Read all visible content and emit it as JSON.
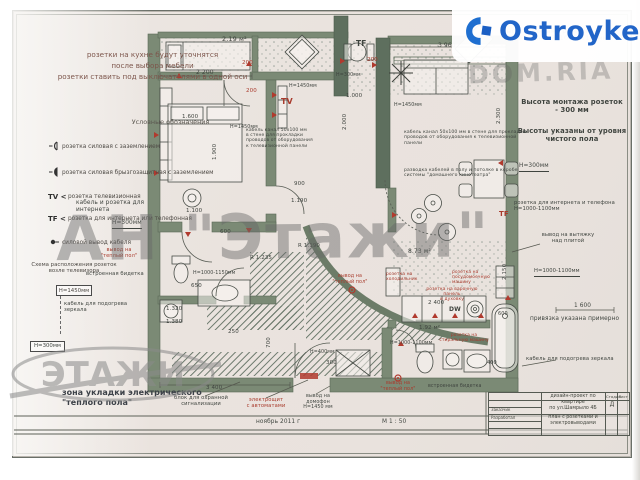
{
  "watermarks": {
    "brand": "Ostroyke",
    "domria": "DOM.RIA",
    "agency": "АН \"Этажи\"",
    "agency_logo": "ЭТАЖИ"
  },
  "notes_top_left": {
    "text": "розетки на кухне будут уточнятся\nпосле выбора мебели\nрозетки ставить под выключателями в одной оси"
  },
  "legend": {
    "title": "Условные обозначения",
    "items": [
      {
        "icon": "socket-grounded-icon",
        "label": "розетка силовая с заземлением"
      },
      {
        "icon": "socket-splashproof-icon",
        "label": "розетка силовая брызгозащитная с заземлением"
      },
      {
        "key": "TV <",
        "label": "розетка телевизионная"
      },
      {
        "key": "TF <",
        "label": "розетка для интернета или телефонная"
      },
      {
        "icon": "cable-outlet-icon",
        "label": "силовой вывод кабеля"
      }
    ]
  },
  "tv_scheme": {
    "title": "Схема расположения розеток\nвозле телевизора",
    "box_top": "Н=1450мм",
    "box_bottom": "Н=300мм"
  },
  "zone_note": "зона укладки электрического\n\"теплого пола\"",
  "title_block": {
    "project": "дизайн-проект по квартире\nпо ул.Шамрыло 4Б",
    "drawing": "план с розетками и\nэлектровыводами",
    "stage_label": "Стадия",
    "sheet_label": "Лист",
    "stage": "Д",
    "row1": "Заказчик",
    "row2": "Разработал"
  },
  "colors": {
    "red": "#a93b2d",
    "ink": "#3f443f",
    "gray2": "#5c5f66"
  },
  "labels": [
    {
      "t": "2.19 м²",
      "x": 222,
      "y": 36,
      "s": 6.5
    },
    {
      "t": "2 200",
      "x": 196,
      "y": 70,
      "s": 6
    },
    {
      "t": "200",
      "x": 242,
      "y": 60,
      "c": "red",
      "s": 5.5
    },
    {
      "t": "200",
      "x": 246,
      "y": 88,
      "c": "red",
      "s": 5.5
    },
    {
      "t": "1.600",
      "x": 182,
      "y": 114,
      "s": 5.5
    },
    {
      "t": "1.900",
      "x": 212,
      "y": 160,
      "r": -90,
      "s": 5.5
    },
    {
      "t": "H=1450мм",
      "x": 230,
      "y": 125,
      "s": 4.8
    },
    {
      "t": "H=1450мм",
      "x": 289,
      "y": 84,
      "s": 4.8
    },
    {
      "t": "TV",
      "x": 281,
      "y": 97,
      "c": "red",
      "s": 8,
      "b": 1
    },
    {
      "t": "1.100",
      "x": 186,
      "y": 208,
      "s": 5.5
    },
    {
      "t": "600",
      "x": 220,
      "y": 229,
      "s": 5.5
    },
    {
      "t": "H=1000-1150мм",
      "x": 193,
      "y": 271,
      "s": 4.8
    },
    {
      "t": "650",
      "x": 191,
      "y": 283,
      "s": 5.5
    },
    {
      "t": "1.320",
      "x": 166,
      "y": 306,
      "s": 5.5
    },
    {
      "t": "1.380",
      "x": 166,
      "y": 319,
      "s": 5.5
    },
    {
      "t": "R 1.235",
      "x": 250,
      "y": 255,
      "s": 5.5
    },
    {
      "t": "R 1.190",
      "x": 298,
      "y": 243,
      "s": 5.5
    },
    {
      "t": "900",
      "x": 294,
      "y": 181,
      "s": 5.5
    },
    {
      "t": "1.190",
      "x": 291,
      "y": 198,
      "s": 5.5
    },
    {
      "t": "700",
      "x": 266,
      "y": 348,
      "r": -90,
      "s": 5.5
    },
    {
      "t": "250",
      "x": 228,
      "y": 329,
      "s": 5.5
    },
    {
      "t": "3 400",
      "x": 206,
      "y": 385,
      "s": 5.5
    },
    {
      "t": "300",
      "x": 326,
      "y": 360,
      "s": 5.5
    },
    {
      "t": "H=400мм",
      "x": 310,
      "y": 350,
      "s": 4.8
    },
    {
      "t": "TF",
      "x": 356,
      "y": 40,
      "s": 7.5,
      "b": 1
    },
    {
      "t": "H=300мм",
      "x": 336,
      "y": 73,
      "s": 4.8
    },
    {
      "t": "1.000",
      "x": 346,
      "y": 93,
      "s": 5.5
    },
    {
      "t": "2.000",
      "x": 342,
      "y": 130,
      "r": -90,
      "s": 5.5
    },
    {
      "t": "200",
      "x": 367,
      "y": 57,
      "c": "red",
      "s": 5.5
    },
    {
      "t": "3 960",
      "x": 438,
      "y": 43,
      "s": 6
    },
    {
      "t": "2.300",
      "x": 496,
      "y": 124,
      "r": -90,
      "s": 5.5
    },
    {
      "t": "H=1450мм",
      "x": 394,
      "y": 103,
      "s": 4.8
    },
    {
      "t": "кабель канал 50х100 мм\nв стене для прокладки\nпроводов от оборудования\nк телевизионной панели",
      "x": 246,
      "y": 128,
      "w": 92,
      "s": 4.5
    },
    {
      "t": "кабель канал 50х100 мм в стене для прокладки\nпроводов от оборудования к телевизионной панели",
      "x": 404,
      "y": 130,
      "w": 124,
      "s": 4.6
    },
    {
      "t": "разводка кабелей в полу и потолке в коробе\nсистемы \"домашнего кинотеатра\"",
      "x": 404,
      "y": 168,
      "w": 124,
      "s": 4.6
    },
    {
      "t": "8.73 м²",
      "x": 408,
      "y": 249,
      "s": 6
    },
    {
      "t": "2.150",
      "x": 502,
      "y": 280,
      "r": -90,
      "s": 5.5
    },
    {
      "t": "TF",
      "x": 499,
      "y": 210,
      "c": "red",
      "s": 7,
      "b": 1
    },
    {
      "t": "розетка на\nхолодильник",
      "x": 386,
      "y": 272,
      "c": "red",
      "s": 4.4,
      "w": 40
    },
    {
      "t": "розетка на\nпосудомоечную машину",
      "x": 452,
      "y": 270,
      "c": "red",
      "s": 4.4,
      "w": 56
    },
    {
      "t": "розетка на варочную панель\nи духовку",
      "x": 420,
      "y": 287,
      "c": "red",
      "s": 4.4,
      "w": 64,
      "a": "c"
    },
    {
      "t": "2 400",
      "x": 428,
      "y": 300,
      "s": 5.5
    },
    {
      "t": "DW",
      "x": 449,
      "y": 307,
      "s": 6,
      "b": 1
    },
    {
      "t": "1.92 м²",
      "x": 419,
      "y": 325,
      "s": 5.5
    },
    {
      "t": "розетка на\nстиральную машину",
      "x": 438,
      "y": 333,
      "c": "red",
      "s": 4.4,
      "w": 52,
      "a": "c"
    },
    {
      "t": "H=1000-1100мм",
      "x": 390,
      "y": 341,
      "s": 4.8
    },
    {
      "t": "600",
      "x": 498,
      "y": 312,
      "s": 5
    },
    {
      "t": "400",
      "x": 487,
      "y": 361,
      "s": 5
    },
    {
      "t": "вывод на\n\"теплый пол\"",
      "x": 330,
      "y": 274,
      "c": "red",
      "s": 4.8,
      "w": 40,
      "a": "c"
    },
    {
      "t": "вывод на\n\"теплый пол\"",
      "x": 378,
      "y": 381,
      "c": "red",
      "s": 4.8,
      "w": 40,
      "a": "c"
    },
    {
      "t": "встроенная бидетка",
      "x": 428,
      "y": 384,
      "s": 4.8,
      "w": 62
    },
    {
      "t": "вывод на\nдомофон\nН=1450 мм",
      "x": 300,
      "y": 394,
      "s": 4.8,
      "w": 36,
      "a": "c"
    },
    {
      "t": "блок для охранной\nсигнализации",
      "x": 172,
      "y": 396,
      "s": 5.2,
      "w": 58,
      "a": "c"
    },
    {
      "t": "электрощит\nс автоматами",
      "x": 242,
      "y": 398,
      "c": "red",
      "s": 5.2,
      "w": 48,
      "a": "c"
    },
    {
      "t": "ноябрь 2011 г",
      "x": 256,
      "y": 419,
      "s": 5.8
    },
    {
      "t": "М 1 : 50",
      "x": 382,
      "y": 419,
      "s": 5.8
    },
    {
      "t": "кабель и розетка для интернета",
      "x": 76,
      "y": 200,
      "s": 5.8,
      "w": 80
    },
    {
      "t": "Н=300мм",
      "x": 112,
      "y": 220,
      "s": 5.8,
      "u": 1
    },
    {
      "t": "вывод на\n\"теплый пол\"",
      "x": 96,
      "y": 248,
      "c": "red",
      "s": 5,
      "w": 46,
      "a": "c"
    },
    {
      "t": "встроенная бидетка",
      "x": 86,
      "y": 272,
      "s": 5.2,
      "w": 64
    },
    {
      "t": "кабель для подогрева зеркала",
      "x": 64,
      "y": 302,
      "s": 5.2,
      "w": 86
    },
    {
      "t": "Высота монтажа розеток на\nкухне и ванной -1000- 1100мм.",
      "x": 502,
      "y": 28,
      "s": 6.4,
      "w": 132,
      "c": "gray2"
    },
    {
      "t": "Высота монтажа розеток\n- 300 мм",
      "x": 516,
      "y": 99,
      "s": 6.8,
      "w": 112,
      "b": 1,
      "a": "c"
    },
    {
      "t": "Высоты указаны от уровня\nчистого пола",
      "x": 512,
      "y": 128,
      "s": 6.8,
      "w": 120,
      "b": 1,
      "a": "c"
    },
    {
      "t": "Н=300мм",
      "x": 519,
      "y": 163,
      "s": 5.8,
      "u": 1
    },
    {
      "t": "розетка для интернета и телефона\nН=1000-1100мм",
      "x": 514,
      "y": 201,
      "s": 5.2,
      "w": 112
    },
    {
      "t": "вывод на вытяжку\nнад плитой",
      "x": 540,
      "y": 233,
      "s": 5.2,
      "w": 56,
      "a": "c"
    },
    {
      "t": "Н=1000-1100мм",
      "x": 534,
      "y": 269,
      "s": 5.2,
      "u": 1
    },
    {
      "t": "1 600",
      "x": 574,
      "y": 303,
      "s": 5.8
    },
    {
      "t": "привязка указана примерно",
      "x": 530,
      "y": 316,
      "s": 5.8,
      "w": 104
    },
    {
      "t": "кабель для подогрева зеркала",
      "x": 526,
      "y": 357,
      "s": 5.2,
      "w": 92
    }
  ]
}
